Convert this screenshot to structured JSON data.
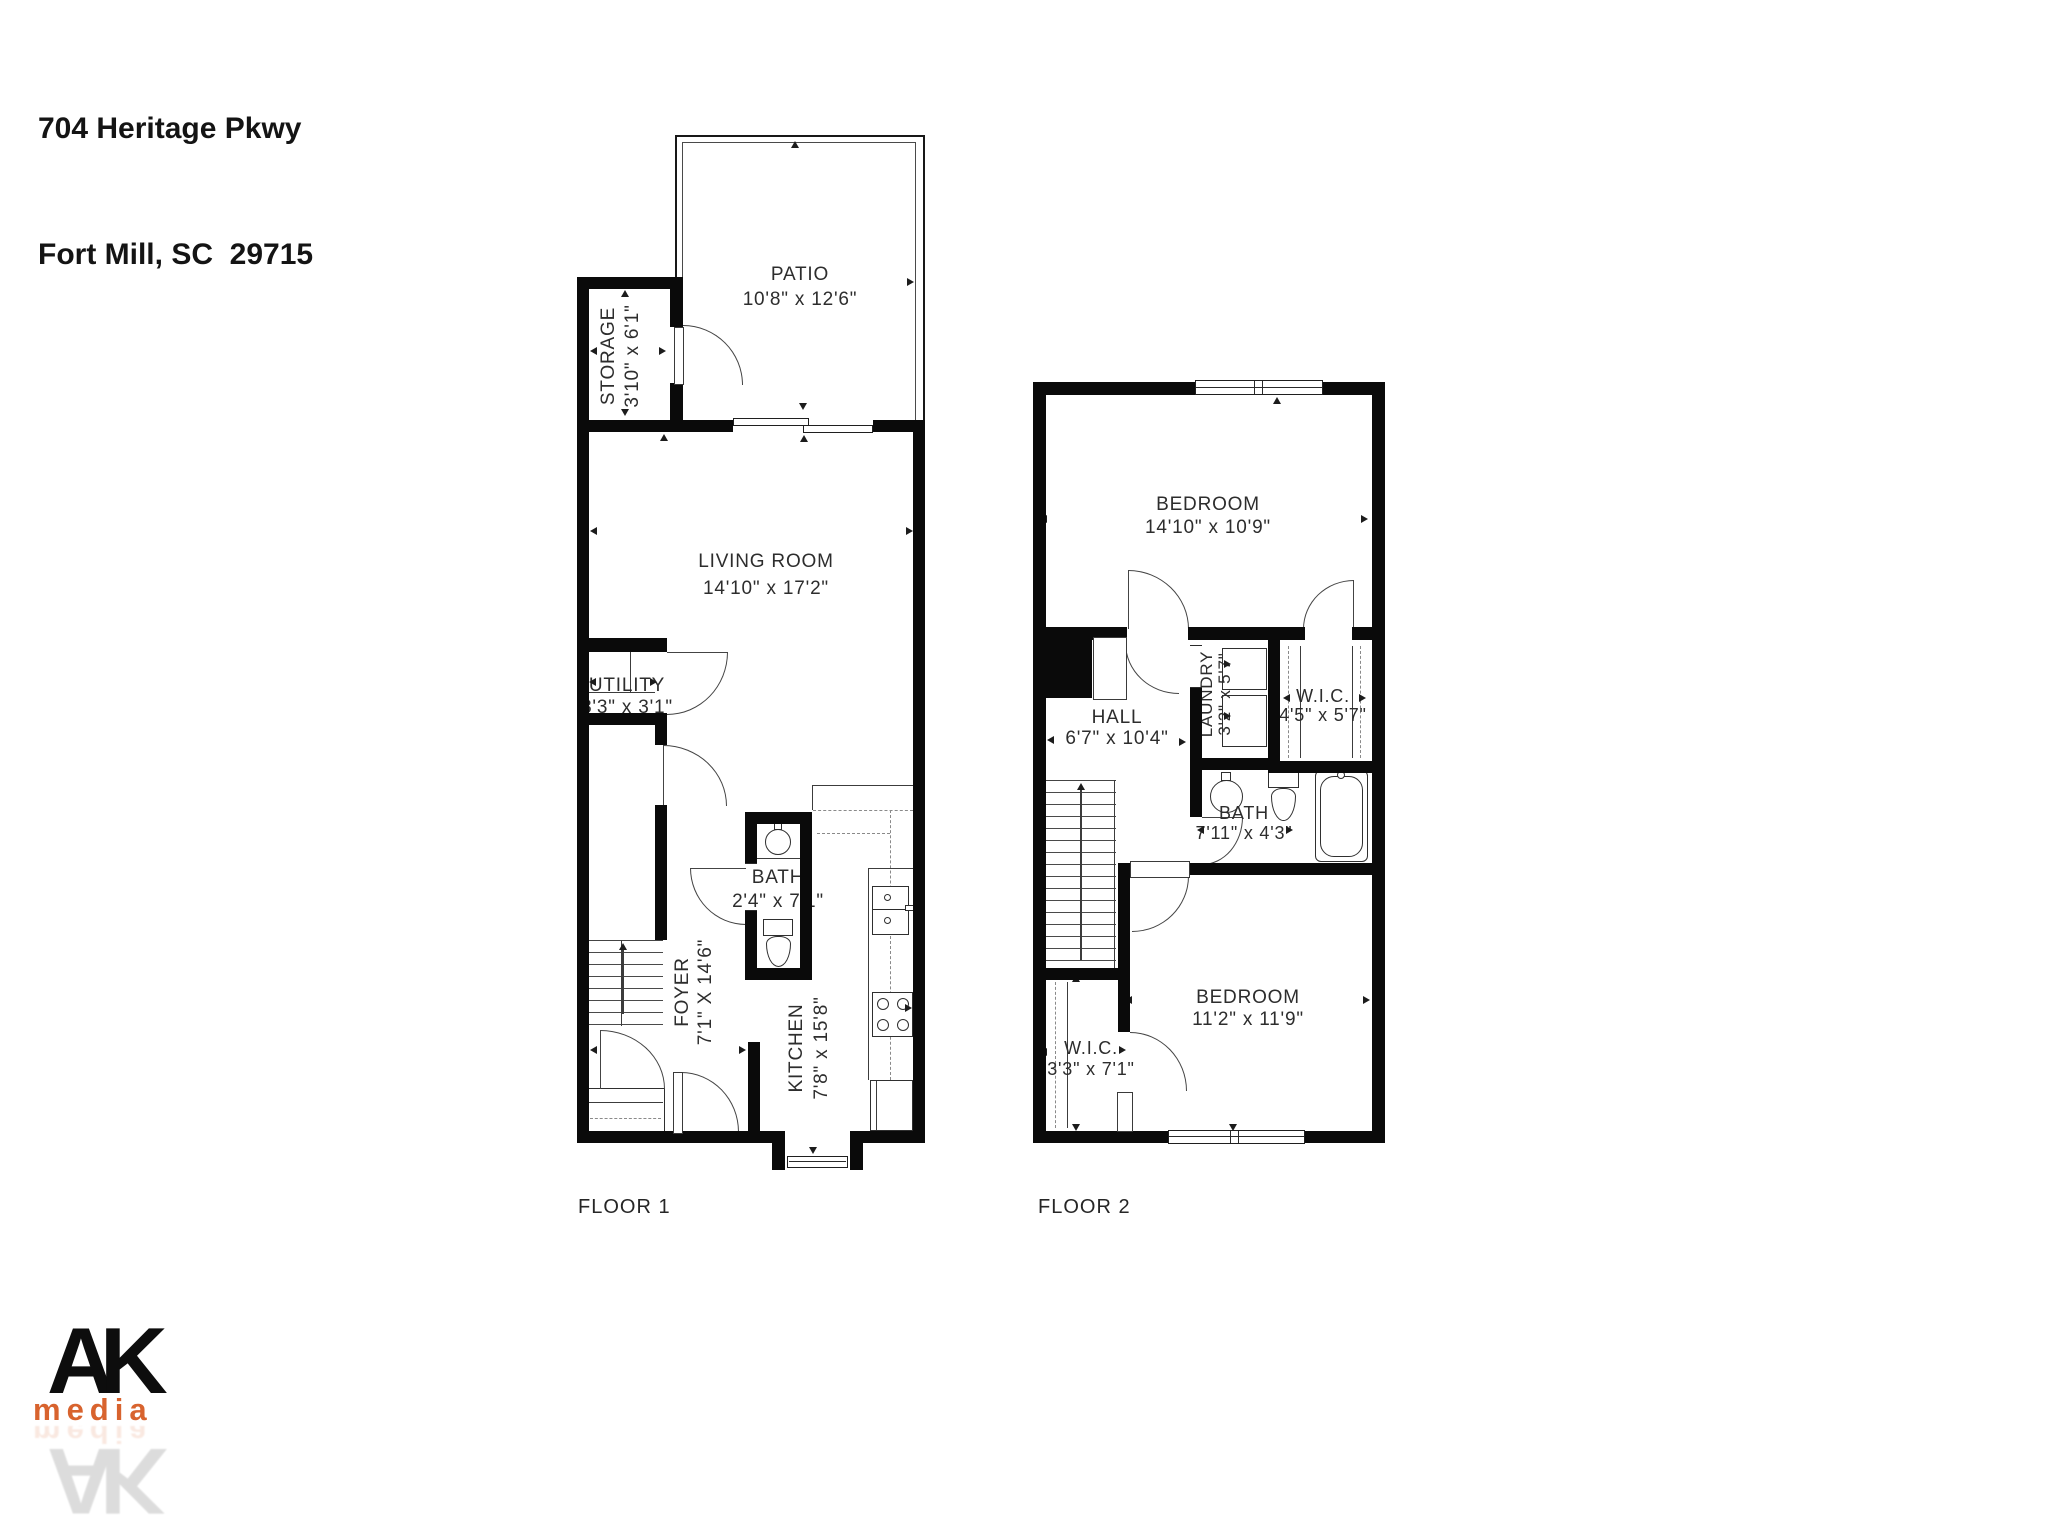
{
  "address": {
    "line1": "704 Heritage Pkwy",
    "line2": "Fort Mill, SC  29715"
  },
  "floors": {
    "floor1": {
      "label": "FLOOR 1",
      "rooms": {
        "patio": {
          "name": "PATIO",
          "dims": "10'8\" x 12'6\""
        },
        "storage": {
          "name": "STORAGE",
          "dims": "3'10\" x 6'1\""
        },
        "living_room": {
          "name": "LIVING ROOM",
          "dims": "14'10\" x 17'2\""
        },
        "utility": {
          "name": "UTILITY",
          "dims": "3'3\" x 3'1\""
        },
        "foyer": {
          "name": "FOYER",
          "dims": "7'1\" X 14'6\""
        },
        "bath": {
          "name": "BATH",
          "dims": "2'4\" x 7'1\""
        },
        "kitchen": {
          "name": "KITCHEN",
          "dims": "7'8\" x 15'8\""
        }
      }
    },
    "floor2": {
      "label": "FLOOR 2",
      "rooms": {
        "bedroom_top": {
          "name": "BEDROOM",
          "dims": "14'10\" x 10'9\""
        },
        "hall": {
          "name": "HALL",
          "dims": "6'7\" x 10'4\""
        },
        "laundry": {
          "name": "LAUNDRY",
          "dims": "3'2\" x 5'7\""
        },
        "wic_top": {
          "name": "W.I.C.",
          "dims": "4'5\" x 5'7\""
        },
        "bath": {
          "name": "BATH",
          "dims": "7'11\" x 4'3\""
        },
        "bedroom_bottom": {
          "name": "BEDROOM",
          "dims": "11'2\" x 11'9\""
        },
        "wic_bottom": {
          "name": "W.I.C.",
          "dims": "3'3\" x 7'1\""
        }
      }
    }
  },
  "logo": {
    "initials": "AK",
    "word": "media",
    "accent_color": "#d8632e",
    "ink_color": "#0d0d0d"
  }
}
